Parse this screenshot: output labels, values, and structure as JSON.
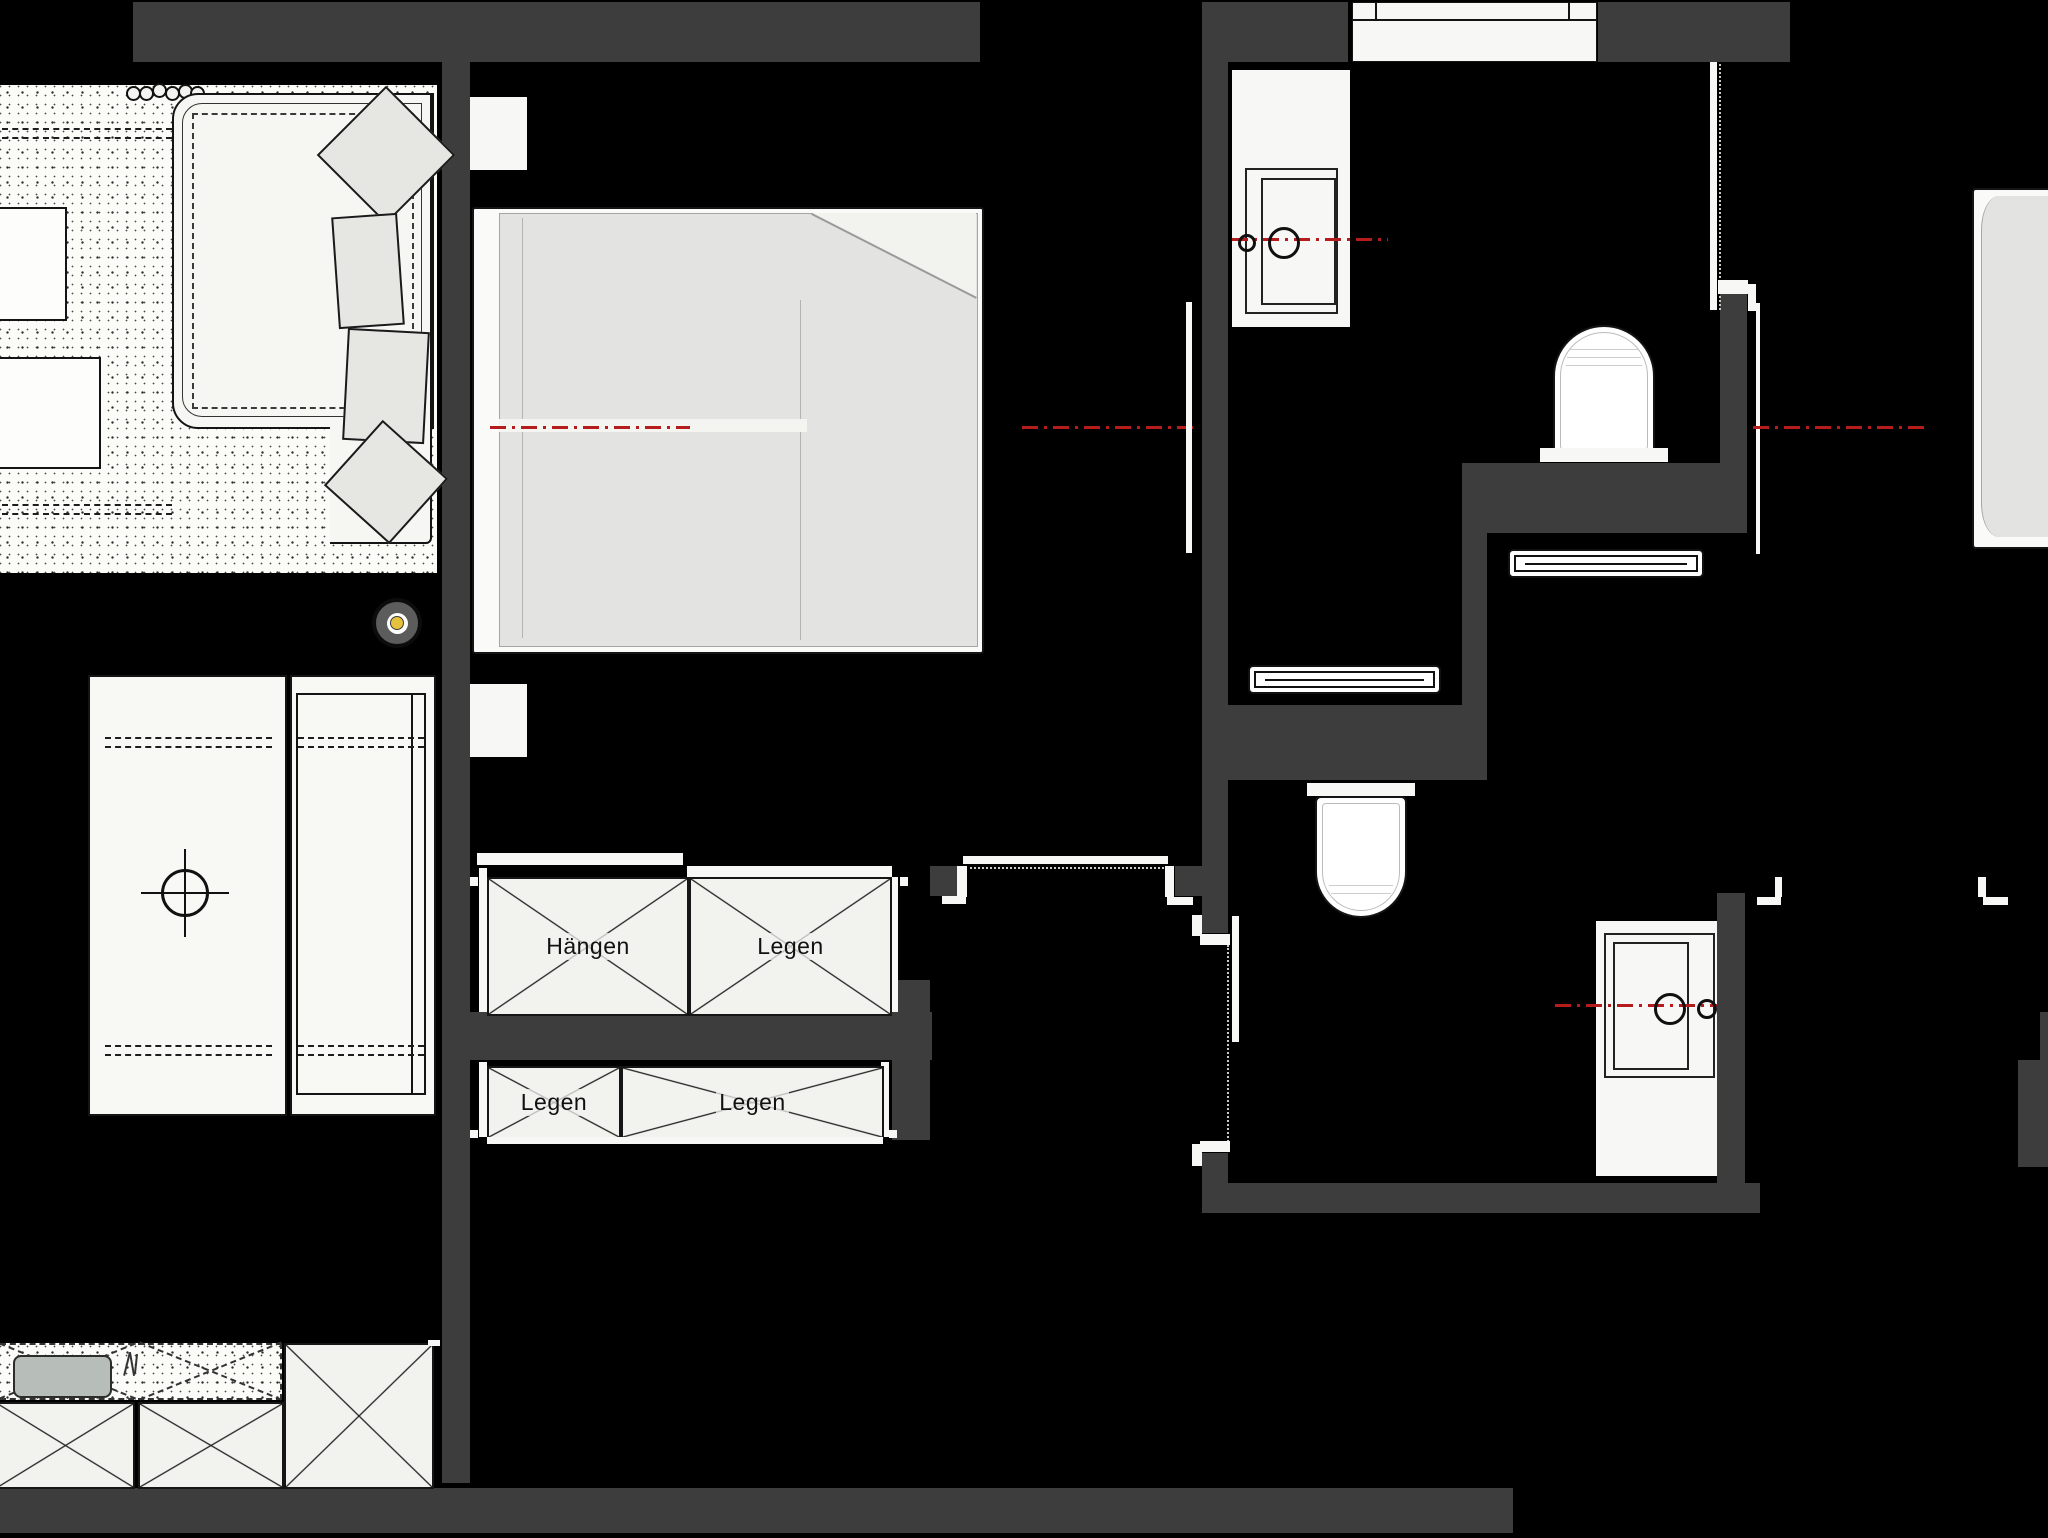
{
  "title": "apartment-floor-plan",
  "wardrobe": {
    "upper": {
      "left_label": "Hängen",
      "right_label": "Legen"
    },
    "lower": {
      "left_label": "Legen",
      "right_label": "Legen"
    }
  },
  "colors": {
    "background": "#000000",
    "wall": "#3d3d3d",
    "fixture_white": "#f7f7f5",
    "furniture_gray": "#e3e3e1",
    "centerline_red": "#b51d1d",
    "lamp_yellow": "#e6c13d",
    "kitchen_sink_gray": "#b7bdb9"
  },
  "fixtures": {
    "living": [
      "sofa",
      "pillows",
      "side-tables",
      "plants-row"
    ],
    "bedroom": [
      "double-bed",
      "ceiling-lamp",
      "wardrobe-hang",
      "wardrobe-lay",
      "desk",
      "sideboard"
    ],
    "bathroom_top": [
      "washbasin-cabinet",
      "toilet",
      "shower-drain",
      "door"
    ],
    "bathroom_bottom": [
      "toilet",
      "washbasin-cabinet",
      "shower-drain",
      "sliding-door"
    ],
    "kitchen": [
      "counter",
      "sink",
      "cabinets",
      "tall-unit"
    ],
    "right_room": [
      "bed"
    ]
  }
}
